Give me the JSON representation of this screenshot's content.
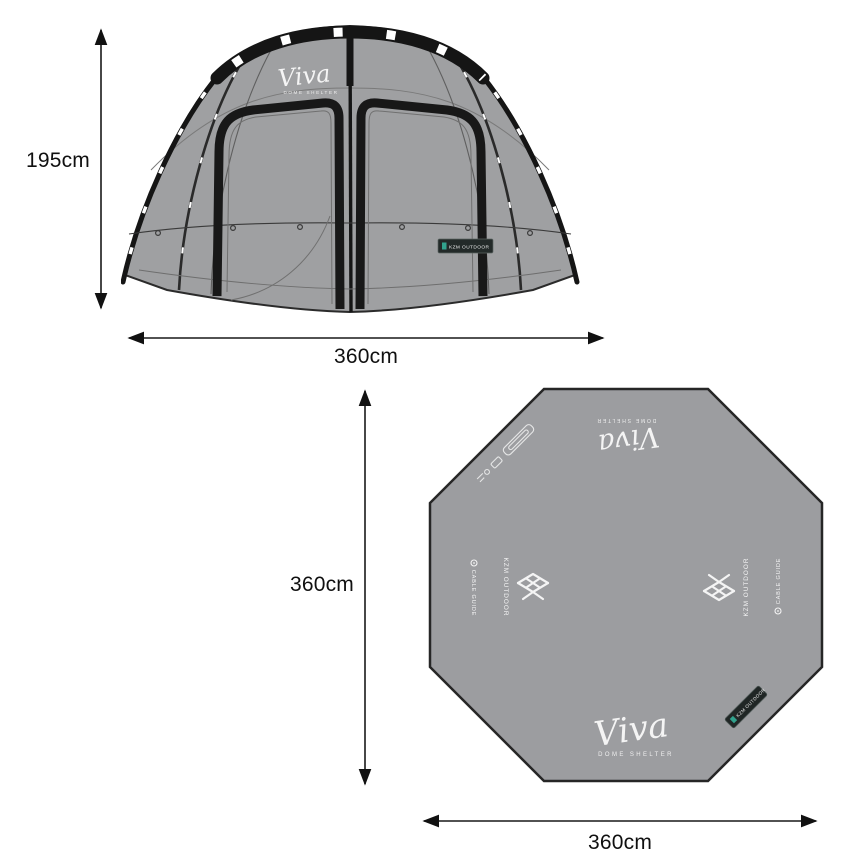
{
  "front_view": {
    "height_label": "195cm",
    "width_label": "360cm",
    "logo_script": "Viva",
    "logo_subtitle": "DOME SHELTER",
    "brand_tag": "KZM OUTDOOR",
    "colors": {
      "fabric": "#9fa0a2",
      "frame": "#161616",
      "tag_bg": "#232a29",
      "tag_accent": "#35b8a0"
    }
  },
  "floor_view": {
    "height_label": "360cm",
    "width_label": "360cm",
    "logo_script": "Viva",
    "logo_subtitle": "DOME SHELTER",
    "brand": "KZM OUTDOOR",
    "cable_guide": "CABLE GUIDE",
    "corner_tag": "KZM OUTDOOR",
    "colors": {
      "fabric": "#9c9da0",
      "outline": "#262626",
      "mark": "#f4f4f4",
      "tag_bg": "#202625",
      "tag_accent": "#35b8a0"
    }
  }
}
